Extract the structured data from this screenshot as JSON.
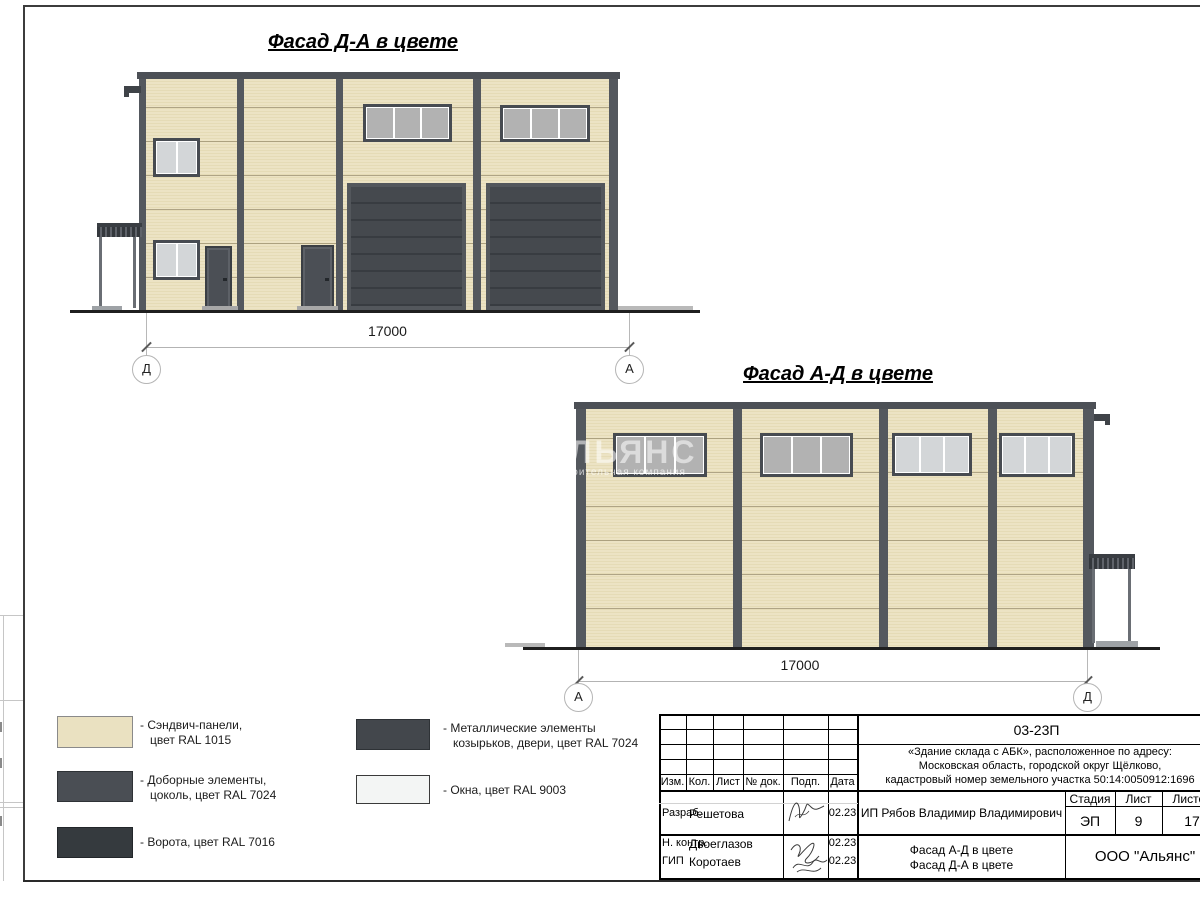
{
  "drawing": {
    "facade_da": {
      "title": "Фасад Д-А в цвете",
      "dimension": "17000",
      "axis_left": "Д",
      "axis_right": "А"
    },
    "facade_ad": {
      "title": "Фасад А-Д в цвете",
      "dimension": "17000",
      "axis_left": "А",
      "axis_right": "Д"
    }
  },
  "colors": {
    "sandwich_panel": "#eae1c1",
    "trim_elements": "#4a4e54",
    "gates": "#353a3e",
    "metal_elements": "#43474c",
    "windows": "#f3f5f4"
  },
  "legend": {
    "items": [
      {
        "line1": "- Сэндвич-панели,",
        "line2": "цвет RAL 1015",
        "color": "#eae1c1"
      },
      {
        "line1": "- Доборные элементы,",
        "line2": "цоколь, цвет RAL 7024",
        "color": "#4a4e54"
      },
      {
        "line1": "- Ворота, цвет RAL 7016",
        "line2": "",
        "color": "#353a3e"
      },
      {
        "line1": "- Металлические элементы",
        "line2": "козырьков, двери, цвет RAL 7024",
        "color": "#43474c"
      },
      {
        "line1": "- Окна, цвет RAL 9003",
        "line2": "",
        "color": "#f3f5f4"
      }
    ]
  },
  "watermark": {
    "line1": "АЛЬЯНС",
    "line2": "строительная компания"
  },
  "title_block": {
    "code": "03-23П",
    "project_line1": "«Здание склада с АБК», расположенное по адресу:",
    "project_line2": "Московская область, городской округ Щёлково,",
    "project_line3": "кадастровый номер земельного участка 50:14:0050912:1696",
    "headers": {
      "izm": "Изм.",
      "kol": "Кол.",
      "list": "Лист",
      "ndok": "№ док.",
      "podp": "Подп.",
      "data": "Дата"
    },
    "rows": [
      {
        "role": "Разраб.",
        "name": "Решетова",
        "date": "02.23"
      },
      {
        "role": "Н. контр.",
        "name": "Двоеглазов",
        "date": "02.23"
      },
      {
        "role": "ГИП",
        "name": "Коротаев",
        "date": "02.23"
      }
    ],
    "client": "ИП Рябов Владимир Владимирович",
    "stage_header": "Стадия",
    "sheet_header": "Лист",
    "sheets_header": "Листов",
    "stage": "ЭП",
    "sheet": "9",
    "sheets": "17",
    "sheet_title_line1": "Фасад А-Д в цвете",
    "sheet_title_line2": "Фасад Д-А в цвете",
    "company": "ООО \"Альянс\""
  }
}
